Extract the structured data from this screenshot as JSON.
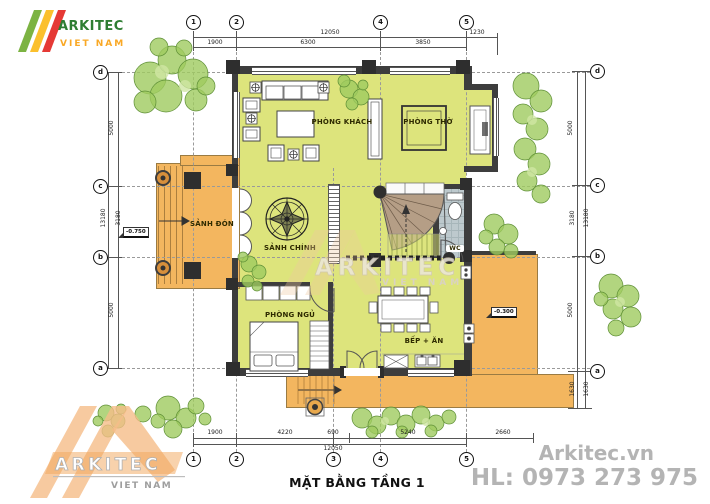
{
  "logo": {
    "brand": "ARKITEC",
    "country": "VIET NAM"
  },
  "watermark_center": {
    "brand": "ARKITEC",
    "country": "VIET NAM"
  },
  "watermark_corner": {
    "brand": "ARKITEC",
    "country": "VIET NAM"
  },
  "title": "MẶT BẰNG TẦNG 1",
  "footer": {
    "website": "Arkitec.vn",
    "hotline": "HL: 0973 273 975"
  },
  "rooms": {
    "living": "PHÒNG KHÁCH",
    "worship": "PHÒNG THỜ",
    "porch": "SẢNH ĐÓN",
    "hall": "SẢNH CHÍNH",
    "bedroom": "PHÒNG NGỦ",
    "kitchen": "BẾP + ĂN",
    "wc": "WC"
  },
  "levels": {
    "porch": "-0.750",
    "patio": "-0.300"
  },
  "grid": {
    "top": [
      "1",
      "2",
      "4",
      "5"
    ],
    "bottom": [
      "1",
      "2",
      "3",
      "4",
      "5"
    ],
    "left": [
      "d",
      "c",
      "b",
      "a"
    ],
    "right": [
      "d",
      "c",
      "b",
      "a"
    ]
  },
  "dims": {
    "top": {
      "total": "12050",
      "seg1": "1900",
      "seg2": "6300",
      "seg3": "3850",
      "ext": "1230"
    },
    "bottom": {
      "total": "12050",
      "seg1": "1900",
      "seg2": "4220",
      "seg3": "690",
      "seg4": "5240",
      "ext": "2660"
    },
    "left": {
      "total": "13180",
      "seg1": "5000",
      "seg2": "3180",
      "seg3": "5000"
    },
    "right": {
      "total": "13180",
      "seg1": "5000",
      "seg2": "3180",
      "seg3": "5000",
      "ext1": "1630",
      "ext2": "1630"
    }
  },
  "colors": {
    "room_fill": "#dde47c",
    "porch_fill": "#f3b65f",
    "wall": "#3d3d3d",
    "tile": "#bdc9cd",
    "stair": "#b59e86",
    "tree": "#9fca5f",
    "gray_text": "#b4b4b4"
  }
}
